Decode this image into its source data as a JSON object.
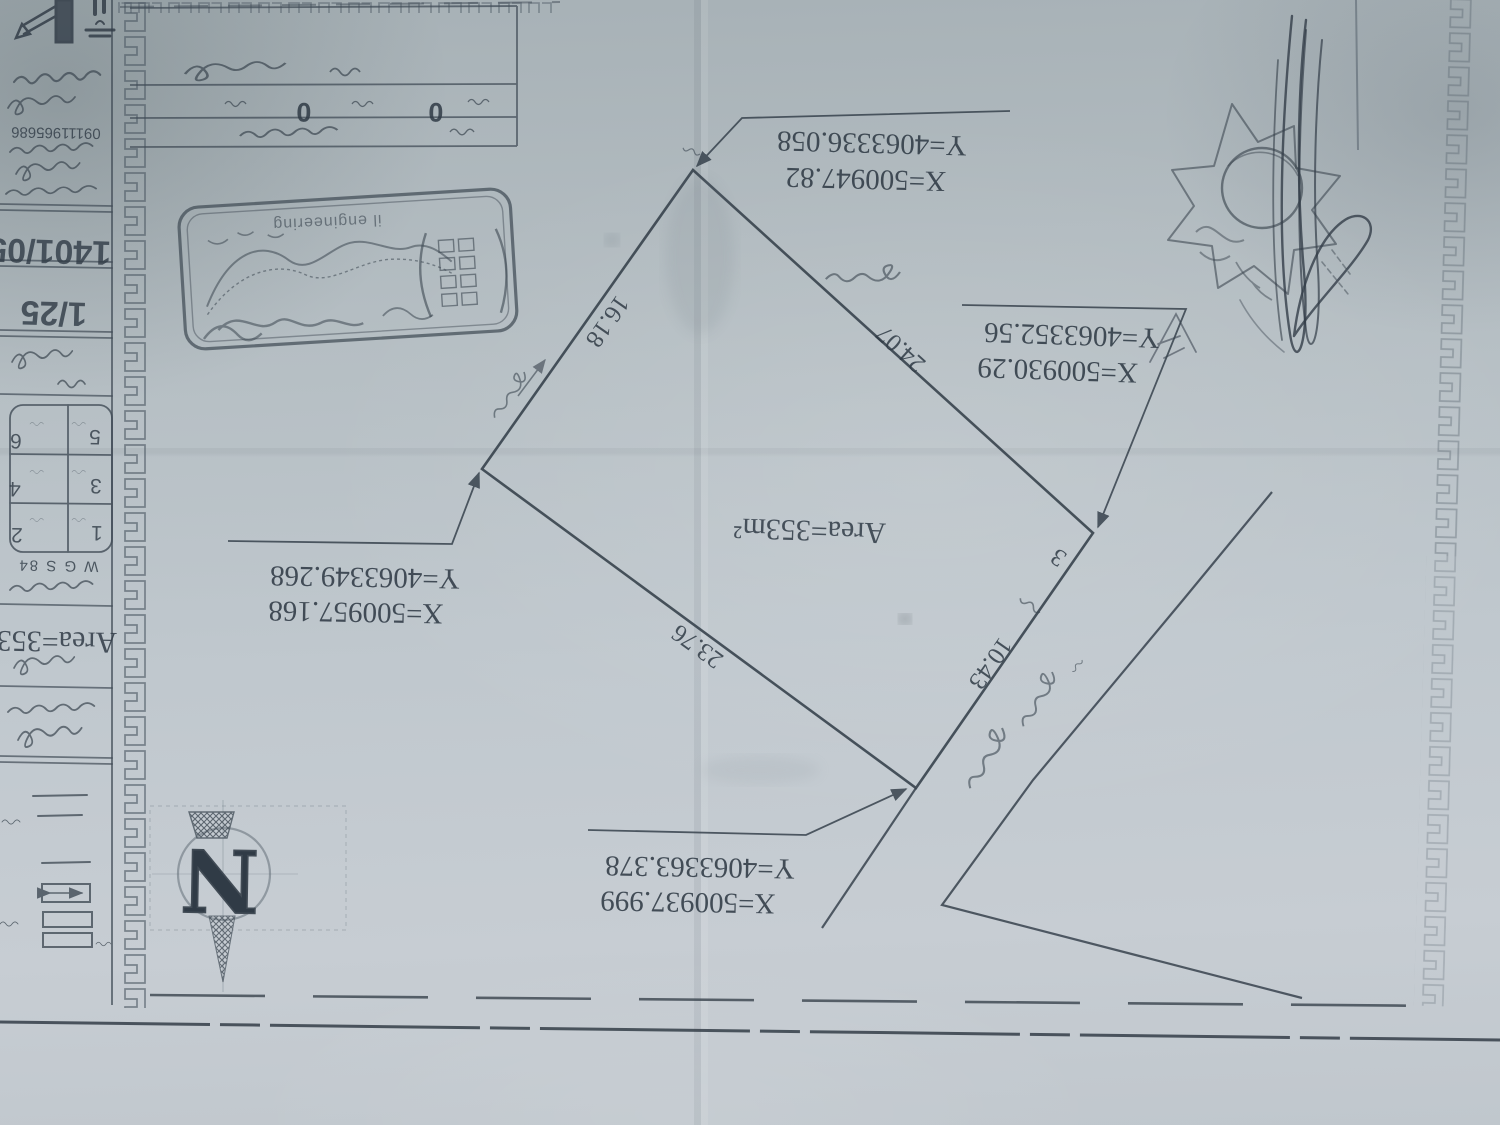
{
  "sheet": {
    "description": "photographed land-survey parcel sheet, rotated 180 degrees",
    "paper_color": "#bfc7cd",
    "ink_color": "#37424d",
    "carpet_colors": [
      "#6e2a2a",
      "#6b5a2e",
      "#2f3a33",
      "#5c1f24",
      "#3a2420"
    ]
  },
  "parcel": {
    "area_label": "Area=353m²",
    "point_number": "3",
    "corners": {
      "top": {
        "x": "X=500947.82",
        "y": "Y=4063336.058"
      },
      "right": {
        "x": "X=500930.29",
        "y": "Y=4063352.56"
      },
      "left": {
        "x": "X=500957.168",
        "y": "Y=4063349.268"
      },
      "bottom": {
        "x": "X=500937.999",
        "y": "Y=4063363.378"
      }
    },
    "edges": {
      "top_left": "16.18",
      "top_right": "24.07",
      "bottom_left": "23.76",
      "bottom_right": "10.43"
    }
  },
  "titleblock": {
    "phone": "09111965686",
    "date": "1401/05",
    "scale": "1/25",
    "datum": "W G S 84",
    "area_short": "Area=353",
    "displayed_grid": [
      "5",
      "6",
      "3",
      "4",
      "1",
      "2"
    ],
    "zeros": [
      "0",
      "0"
    ]
  },
  "stamp": {
    "latin_text": "il engineering"
  },
  "north": {
    "label": "N"
  }
}
